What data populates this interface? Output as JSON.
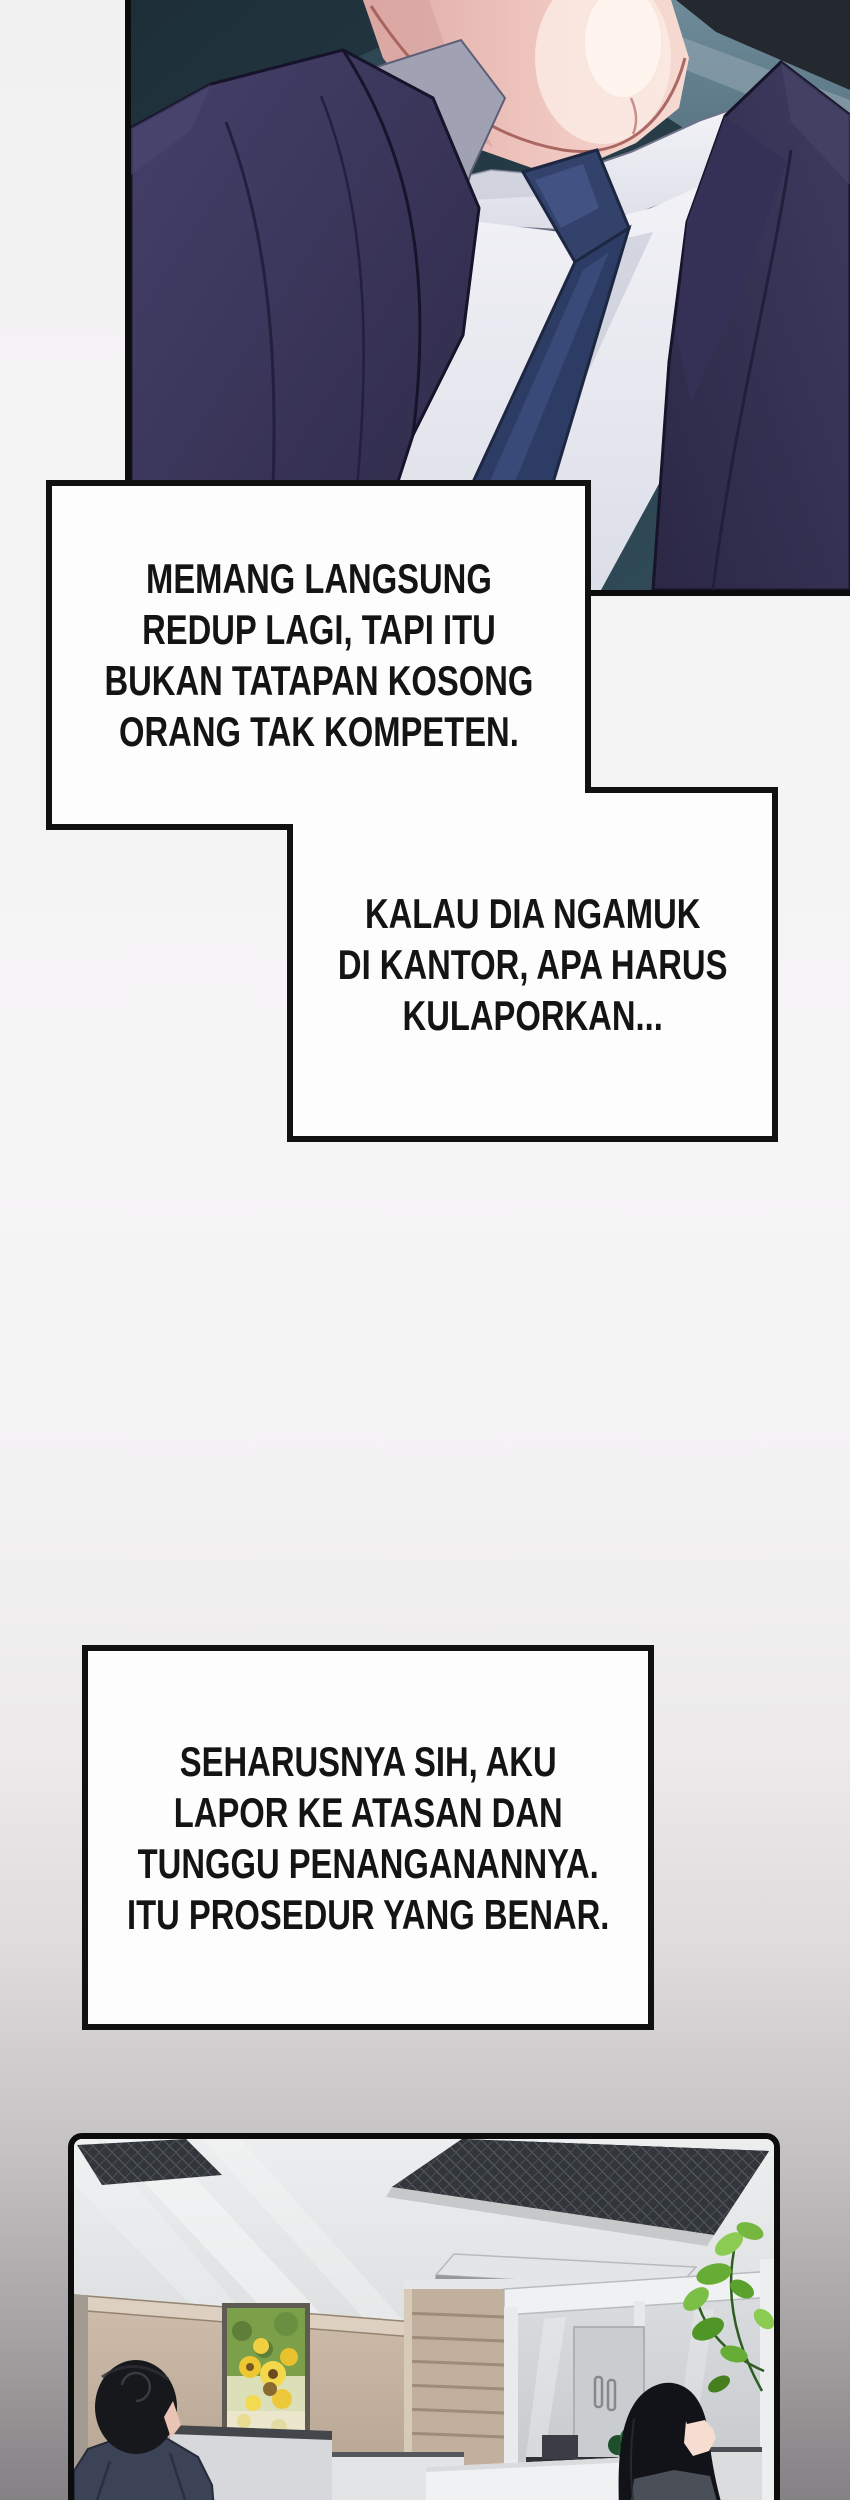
{
  "page": {
    "kind": "manhwa-comic-page",
    "background_top": "#f2f1f2",
    "background_bottom": "#828082"
  },
  "speech": {
    "box1": {
      "lines": [
        "MEMANG LANGSUNG",
        "REDUP LAGI, TAPI ITU",
        "BUKAN TATAPAN KOSONG",
        "ORANG TAK KOMPETEN."
      ]
    },
    "box2": {
      "lines": [
        "KALAU DIA NGAMUK",
        "DI KANTOR, APA HARUS",
        "KULAPORKAN..."
      ]
    },
    "box3": {
      "lines": [
        "SEHARUSNYA SIH, AKU",
        "LAPOR KE ATASAN DAN",
        "TUNGGU PENANGANANNYA.",
        "ITU PROSEDUR YANG BENAR."
      ]
    }
  },
  "illustrations": {
    "portrait_panel": {
      "subject": "close-up of man in purple suit with navy tie, head cropped",
      "colors": {
        "background_teal": "#253943",
        "ceiling_blue": "#5b7785",
        "jacket_purple": "#3c3859",
        "lapel_gray": "#a0a1b3",
        "shirt_white": "#f2f2f6",
        "tie_navy": "#2d3c64",
        "skin_pink": "#eec2ba"
      }
    },
    "office_panel": {
      "subject": "office interior with ceiling vents, sunflower painting, glass partition, two workers, plant",
      "colors": {
        "ceiling": "#e7e9ea",
        "vent_dark": "#32363b",
        "wall_tan": "#c3b1a0",
        "sunflower_yellow": "#eec832",
        "leaf_green": "#6fb23f",
        "partition_gray": "#d8dadc",
        "hair_black": "#15161c"
      }
    }
  }
}
